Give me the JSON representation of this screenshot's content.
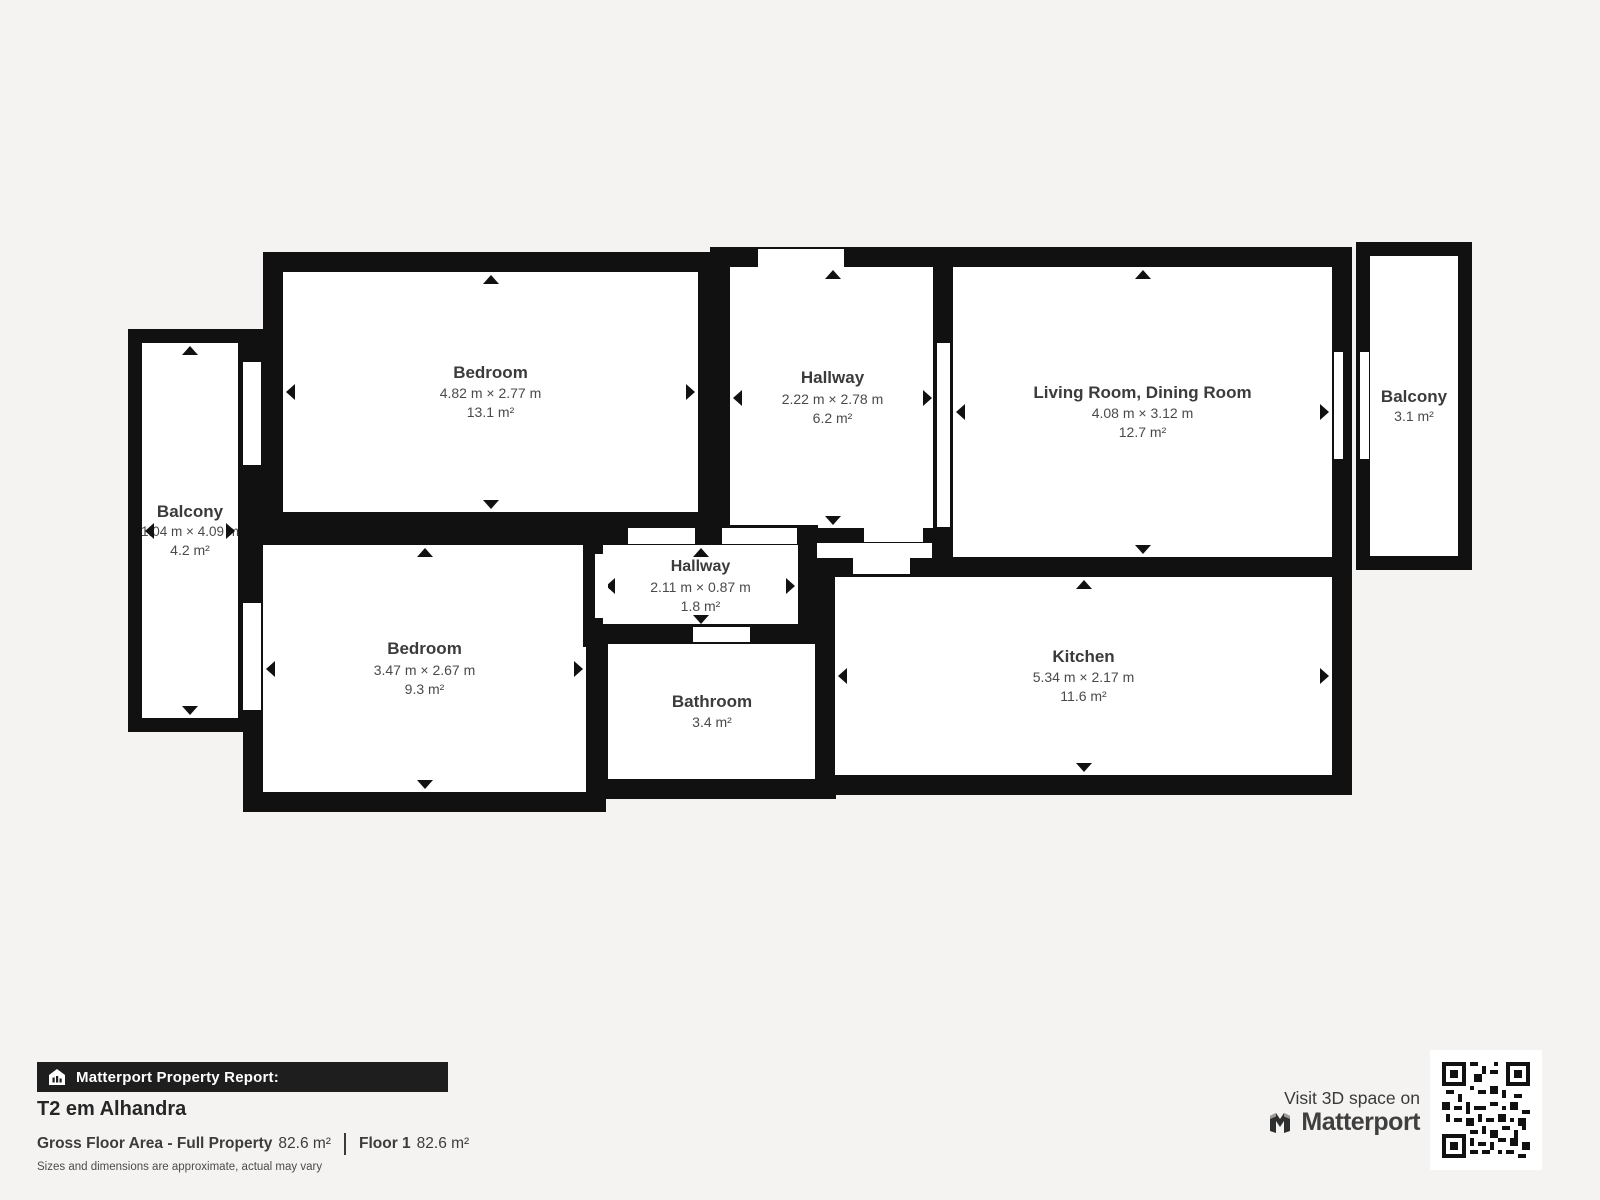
{
  "plan": {
    "rooms": [
      {
        "id": "bedroom-1",
        "name": "Bedroom",
        "dims": "4.82 m × 2.77 m",
        "area": "13.1 m²"
      },
      {
        "id": "hallway-top",
        "name": "Hallway",
        "dims": "2.22 m × 2.78 m",
        "area": "6.2 m²"
      },
      {
        "id": "living-dining",
        "name": "Living Room, Dining Room",
        "dims": "4.08 m × 3.12 m",
        "area": "12.7 m²"
      },
      {
        "id": "balcony-right",
        "name": "Balcony",
        "area": "3.1 m²"
      },
      {
        "id": "balcony-left",
        "name": "Balcony",
        "dims": "1.04 m × 4.09 m",
        "area": "4.2 m²"
      },
      {
        "id": "bedroom-2",
        "name": "Bedroom",
        "dims": "3.47 m × 2.67 m",
        "area": "9.3 m²"
      },
      {
        "id": "hallway-small",
        "name": "Hallway",
        "dims": "2.11 m × 0.87 m",
        "area": "1.8 m²"
      },
      {
        "id": "bathroom",
        "name": "Bathroom",
        "area": "3.4 m²"
      },
      {
        "id": "kitchen",
        "name": "Kitchen",
        "dims": "5.34 m × 2.17 m",
        "area": "11.6 m²"
      }
    ]
  },
  "report": {
    "bar_label": "Matterport Property Report:",
    "property_title": "T2 em Alhandra",
    "gross_label": "Gross Floor Area - Full Property",
    "gross_value": "82.6 m²",
    "floor_label": "Floor 1",
    "floor_value": "82.6 m²",
    "disclaimer": "Sizes and dimensions are approximate, actual may vary"
  },
  "cta": {
    "visit_text": "Visit 3D space on",
    "brand": "Matterport"
  },
  "icons": {
    "house": "house-icon",
    "matterport_mark": "matterport-logo-icon",
    "qr": "qr-code"
  },
  "colors": {
    "background": "#f4f3f2",
    "wall": "#111111",
    "room_fill": "#ffffff",
    "report_bar": "#1e1e1e",
    "label_text": "#3b3b3b"
  }
}
